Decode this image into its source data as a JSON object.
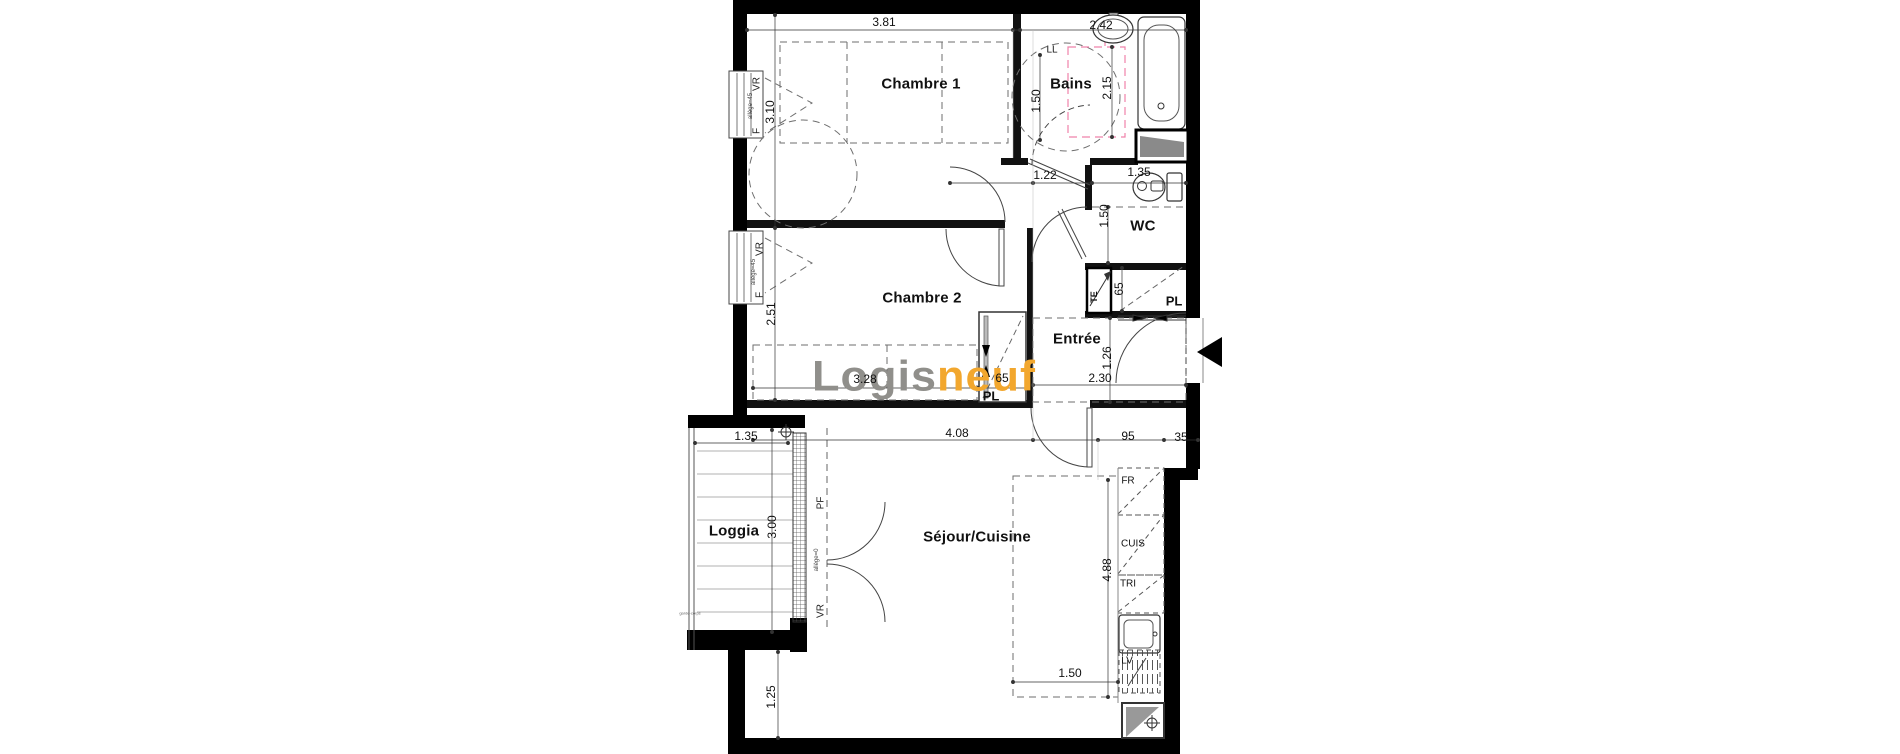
{
  "canvas": {
    "width": 1900,
    "height": 754,
    "background": "#ffffff"
  },
  "logo": {
    "gray_text": "Logis",
    "orange_text": "neuf",
    "gray_color": "#908f8b",
    "orange_color": "#f2a72e"
  },
  "palette": {
    "wall": "#000000",
    "interior_wall": "#111111",
    "line": "#3a3a3a",
    "dashed": "#6e6e6e",
    "pink_dashed": "#ef82aa",
    "shaft_gray": "#8a8a8a"
  },
  "labels": [
    {
      "name": "chambre1-label",
      "text": "Chambre 1",
      "x": 921,
      "y": 84,
      "cls": "room"
    },
    {
      "name": "bains-label",
      "text": "Bains",
      "x": 1071,
      "y": 84,
      "cls": "room"
    },
    {
      "name": "chambre2-label",
      "text": "Chambre 2",
      "x": 922,
      "y": 298,
      "cls": "room"
    },
    {
      "name": "wc-label",
      "text": "WC",
      "x": 1143,
      "y": 226,
      "cls": "room"
    },
    {
      "name": "entree-label",
      "text": "Entrée",
      "x": 1077,
      "y": 339,
      "cls": "room"
    },
    {
      "name": "sejour-cuisine-label",
      "text": "Séjour/Cuisine",
      "x": 977,
      "y": 537,
      "cls": "room"
    },
    {
      "name": "loggia-label",
      "text": "Loggia",
      "x": 734,
      "y": 531,
      "cls": "room"
    },
    {
      "name": "placard-entree-label",
      "text": "PL",
      "x": 1174,
      "y": 301,
      "cls": "eqbold"
    },
    {
      "name": "placard-chambre2-label",
      "text": "PL",
      "x": 991,
      "y": 396,
      "cls": "eqbold"
    },
    {
      "name": "tableau-electrique-label",
      "text": "TE",
      "x": 1094,
      "y": 297,
      "cls": "eqv"
    },
    {
      "name": "lave-linge-label",
      "text": "LL",
      "x": 1052,
      "y": 50,
      "cls": "eq"
    },
    {
      "name": "frigo-label",
      "text": "FR",
      "x": 1128,
      "y": 481,
      "cls": "eq"
    },
    {
      "name": "cuisine-label",
      "text": "CUIS",
      "x": 1133,
      "y": 544,
      "cls": "eq"
    },
    {
      "name": "tri-label",
      "text": "TRI",
      "x": 1128,
      "y": 584,
      "cls": "eq"
    },
    {
      "name": "lave-vaisselle-label",
      "text": "LV",
      "x": 1127,
      "y": 661,
      "cls": "eq"
    },
    {
      "name": "chambre1-window-vr",
      "text": "VR",
      "x": 757,
      "y": 84,
      "cls": "winv"
    },
    {
      "name": "chambre1-window-allege",
      "text": "allège=45",
      "x": 751,
      "y": 106,
      "cls": "winvs"
    },
    {
      "name": "chambre1-window-f",
      "text": "F",
      "x": 757,
      "y": 131,
      "cls": "winv"
    },
    {
      "name": "chambre2-window-vr",
      "text": "VR",
      "x": 760,
      "y": 249,
      "cls": "winv"
    },
    {
      "name": "chambre2-window-allege",
      "text": "allège=45",
      "x": 754,
      "y": 272,
      "cls": "winvs"
    },
    {
      "name": "chambre2-window-f",
      "text": "F",
      "x": 760,
      "y": 295,
      "cls": "winv"
    },
    {
      "name": "loggia-pf-label",
      "text": "PF",
      "x": 821,
      "y": 503,
      "cls": "winv"
    },
    {
      "name": "loggia-allege",
      "text": "allège=0",
      "x": 817,
      "y": 560,
      "cls": "winvs"
    },
    {
      "name": "loggia-vr-label",
      "text": "VR",
      "x": 821,
      "y": 611,
      "cls": "winv"
    },
    {
      "name": "loggia-note",
      "text": "garde-corps",
      "x": 690,
      "y": 613,
      "cls": "tiny"
    },
    {
      "name": "dim-381",
      "text": "3.81",
      "x": 884,
      "y": 22,
      "cls": "dim"
    },
    {
      "name": "dim-242",
      "text": "2.42",
      "x": 1101,
      "y": 25,
      "cls": "dim"
    },
    {
      "name": "dim-310",
      "text": "3.10",
      "x": 770,
      "y": 112,
      "cls": "dimv"
    },
    {
      "name": "dim-150-bains",
      "text": "1.50",
      "x": 1036,
      "y": 101,
      "cls": "dimv"
    },
    {
      "name": "dim-215",
      "text": "2.15",
      "x": 1107,
      "y": 88,
      "cls": "dimv"
    },
    {
      "name": "dim-122",
      "text": "1.22",
      "x": 1045,
      "y": 175,
      "cls": "dim"
    },
    {
      "name": "dim-135-wc",
      "text": "1.35",
      "x": 1139,
      "y": 172,
      "cls": "dim"
    },
    {
      "name": "dim-150-wc",
      "text": "1.50",
      "x": 1104,
      "y": 216,
      "cls": "dimv"
    },
    {
      "name": "dim-65-te",
      "text": "65",
      "x": 1119,
      "y": 289,
      "cls": "dimv"
    },
    {
      "name": "dim-251",
      "text": "2.51",
      "x": 771,
      "y": 314,
      "cls": "dimv"
    },
    {
      "name": "dim-328",
      "text": "3.28",
      "x": 865,
      "y": 379,
      "cls": "dim"
    },
    {
      "name": "dim-65-pl",
      "text": "65",
      "x": 1002,
      "y": 378,
      "cls": "dim"
    },
    {
      "name": "dim-126",
      "text": "1.26",
      "x": 1107,
      "y": 358,
      "cls": "dimv"
    },
    {
      "name": "dim-230",
      "text": "2.30",
      "x": 1100,
      "y": 378,
      "cls": "dim"
    },
    {
      "name": "dim-135-loggia",
      "text": "1.35",
      "x": 746,
      "y": 436,
      "cls": "dim"
    },
    {
      "name": "dim-300",
      "text": "3.00",
      "x": 772,
      "y": 527,
      "cls": "dimv"
    },
    {
      "name": "dim-408",
      "text": "4.08",
      "x": 957,
      "y": 433,
      "cls": "dim"
    },
    {
      "name": "dim-95",
      "text": "95",
      "x": 1128,
      "y": 436,
      "cls": "dim"
    },
    {
      "name": "dim-35",
      "text": "35",
      "x": 1181,
      "y": 437,
      "cls": "dim"
    },
    {
      "name": "dim-488",
      "text": "4.88",
      "x": 1107,
      "y": 570,
      "cls": "dimv"
    },
    {
      "name": "dim-150-cuisine",
      "text": "1.50",
      "x": 1070,
      "y": 673,
      "cls": "dim"
    },
    {
      "name": "dim-125",
      "text": "1.25",
      "x": 771,
      "y": 697,
      "cls": "dimv"
    }
  ]
}
